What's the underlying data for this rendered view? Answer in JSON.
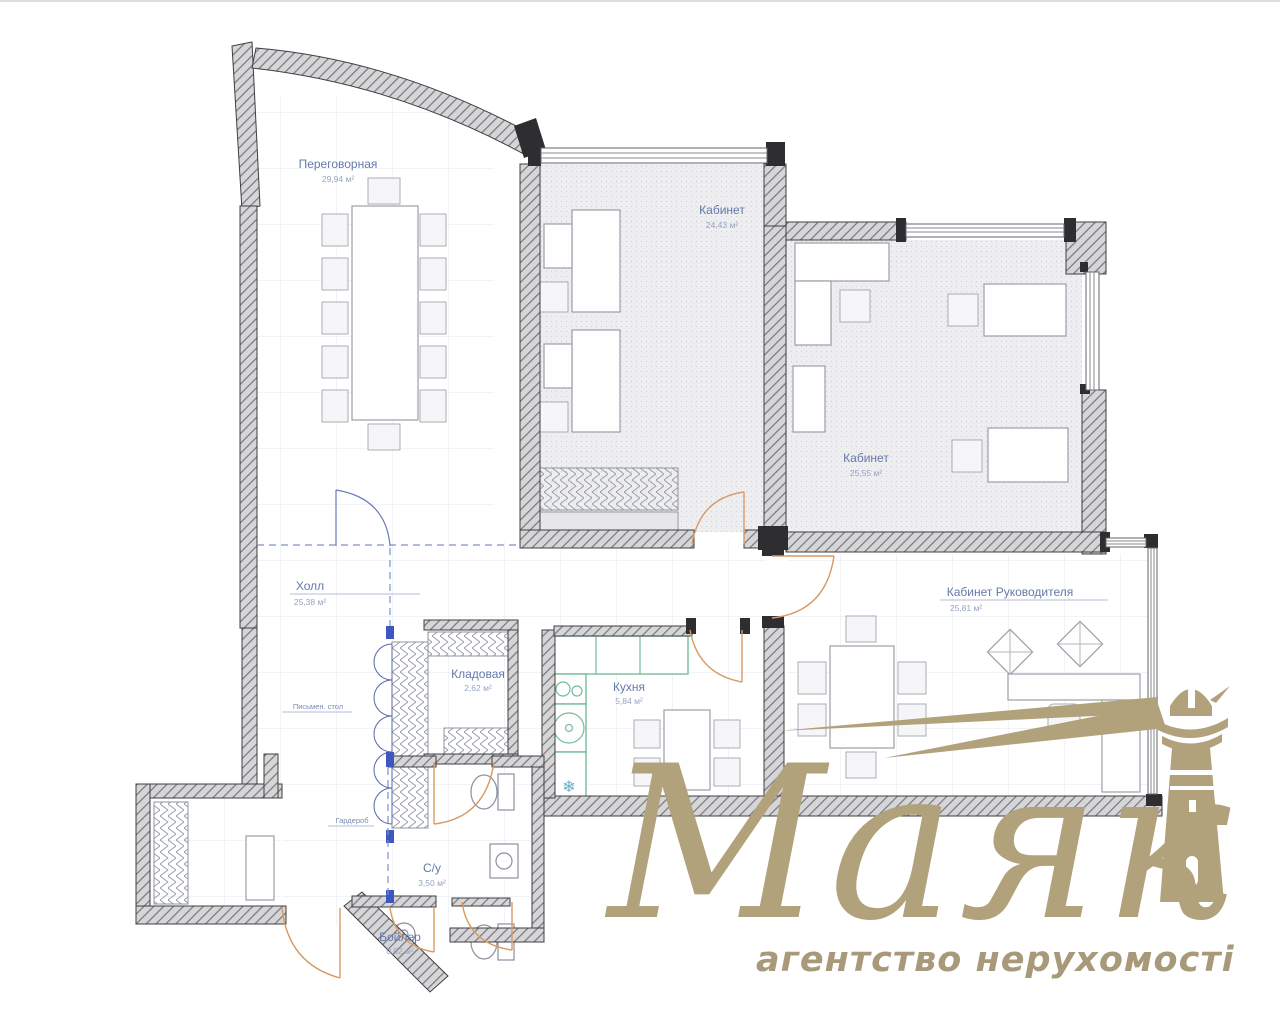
{
  "plan": {
    "rooms": [
      {
        "name": "Переговорная",
        "area": "29,94 м²"
      },
      {
        "name": "Кабинет",
        "area": "24,43 м²"
      },
      {
        "name": "Кабинет",
        "area": "25,55 м²"
      },
      {
        "name": "Кабинет Руководителя",
        "area": "25,81 м²"
      },
      {
        "name": "Холл",
        "area": "25,38 м²"
      },
      {
        "name": "Кладовая",
        "area": "2,62 м²"
      },
      {
        "name": "Кухня",
        "area": "5,84 м²"
      },
      {
        "name": "С/у",
        "area": "3,50 м²"
      },
      {
        "name": "Бойлер",
        "area": "0,52 м²"
      }
    ],
    "annotations": [
      {
        "text": "Письмен. стол"
      },
      {
        "text": "Гардероб"
      }
    ],
    "colors": {
      "label": "#6479a8",
      "wall": "#3f3f42",
      "door": "#d89a62",
      "kitchen": "#74bd98",
      "accent_blue": "#3d56c0"
    }
  },
  "watermark": {
    "title": "Маяк",
    "subtitle": "агентство нерухомості",
    "color": "#b1a27c"
  }
}
